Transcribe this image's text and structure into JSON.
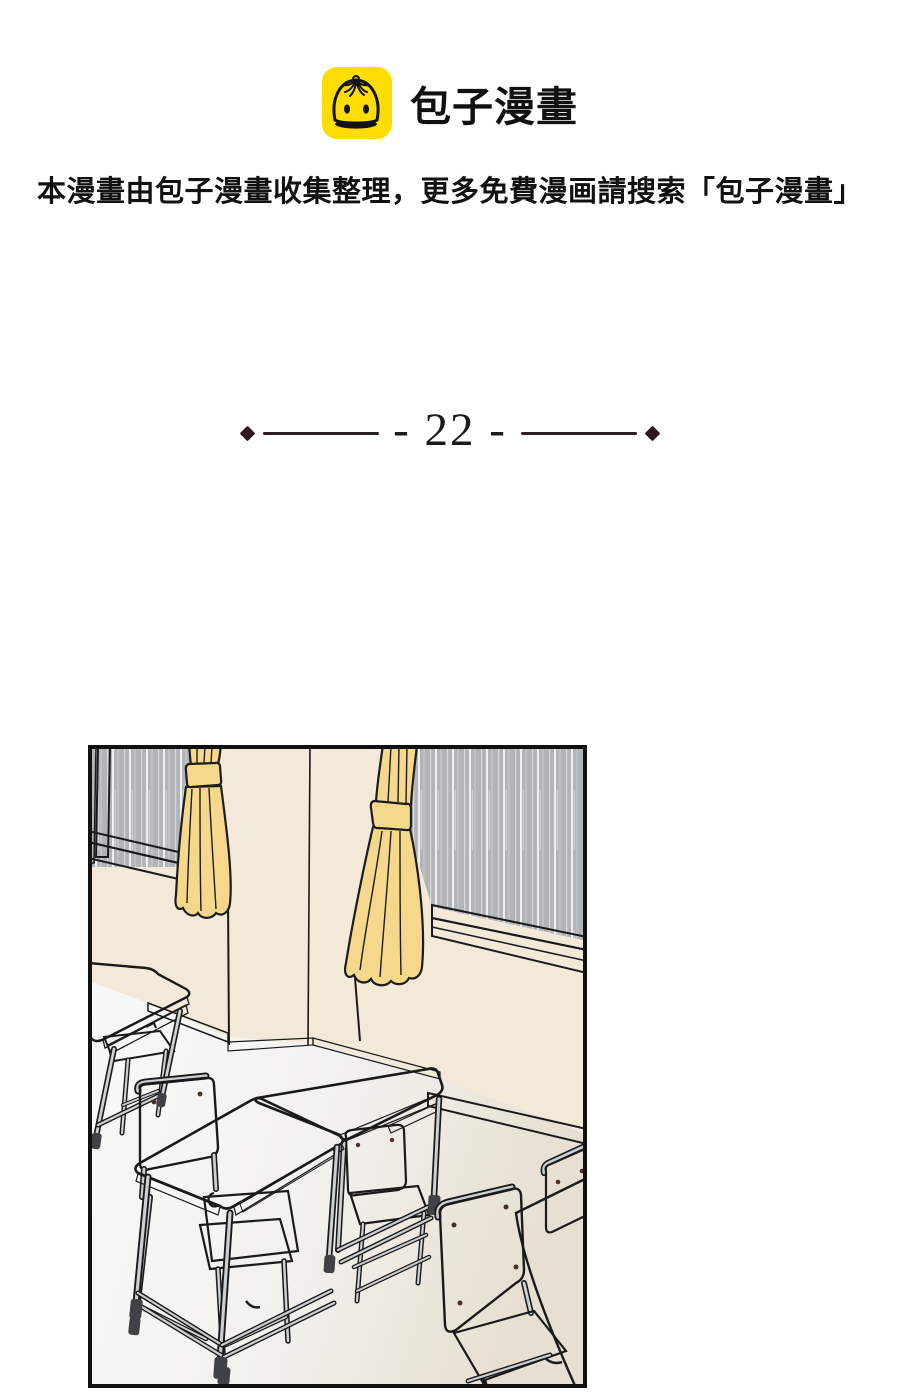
{
  "header": {
    "logo_text": "包子漫畫",
    "logo_icon": "baozi-bun-icon"
  },
  "notice": {
    "text": "本漫畫由包子漫畫收集整理，更多免費漫画請搜索「包子漫畫」"
  },
  "chapter_divider": {
    "label": "- 22 -",
    "number": "22",
    "ornament": "diamond"
  },
  "panel": {
    "description": "empty classroom on a rainy day: two windows with rain outside, yellow tied-back curtains, cream walls, paired school desks and chairs"
  },
  "colors": {
    "page_bg": "#FFFFFF",
    "logo_yellow": "#FFDD00",
    "text": "#111111",
    "divider": "#2B1F24",
    "diamond": "#31161F",
    "wall": "#F2E9D8",
    "glass": "#B1B5B8",
    "sill": "#9EA2A4",
    "sill_light": "#C9CCCB",
    "curtain": "#F6D88C",
    "rail": "#6B4E44",
    "wood": "#E2BC99",
    "wood_dark": "#C69E7D",
    "apron": "#EFEFEC",
    "metal": "#CDD0D2",
    "cap": "#3F4144"
  }
}
